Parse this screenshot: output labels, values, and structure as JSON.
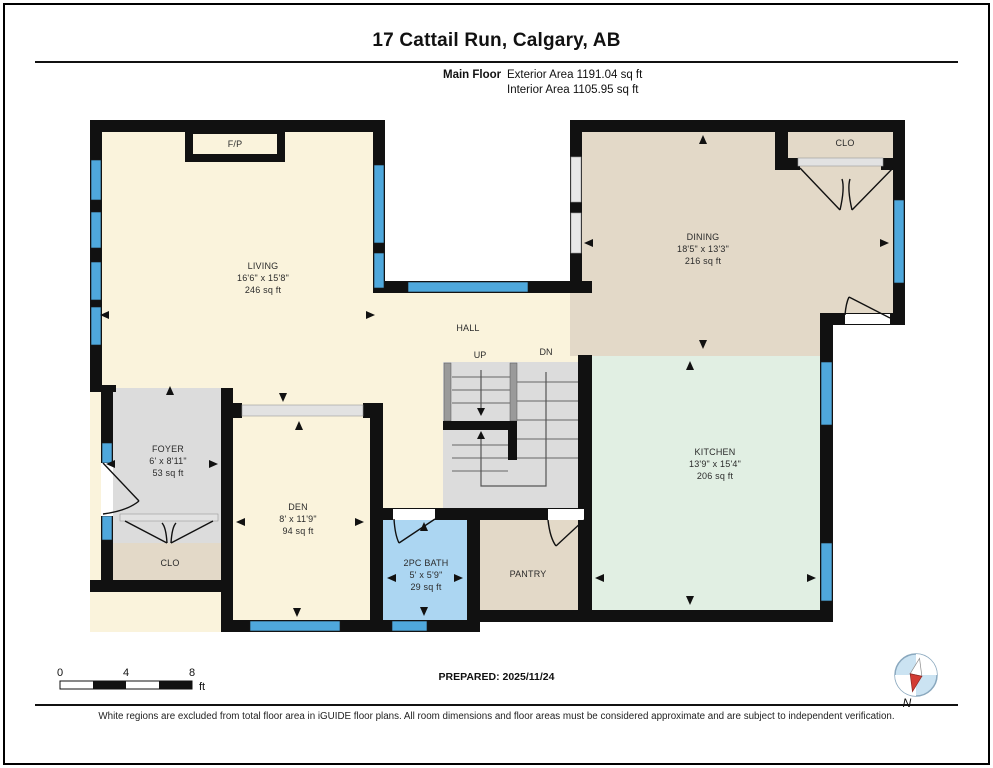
{
  "header": {
    "title": "17 Cattail Run, Calgary, AB",
    "floor_label": "Main Floor",
    "exterior_area": "Exterior Area 1191.04 sq ft",
    "interior_area": "Interior Area 1105.95 sq ft"
  },
  "rooms": {
    "living": {
      "name": "LIVING",
      "dims": "16'6\" x 15'8\"",
      "area": "246 sq ft"
    },
    "dining": {
      "name": "DINING",
      "dims": "18'5\" x 13'3\"",
      "area": "216 sq ft"
    },
    "kitchen": {
      "name": "KITCHEN",
      "dims": "13'9\" x 15'4\"",
      "area": "206 sq ft"
    },
    "foyer": {
      "name": "FOYER",
      "dims": "6' x 8'11\"",
      "area": "53 sq ft"
    },
    "den": {
      "name": "DEN",
      "dims": "8' x 11'9\"",
      "area": "94 sq ft"
    },
    "bath": {
      "name": "2PC BATH",
      "dims": "5' x 5'9\"",
      "area": "29 sq ft"
    },
    "pantry": {
      "name": "PANTRY"
    },
    "hall": {
      "name": "HALL"
    },
    "closet_upper": {
      "name": "CLO"
    },
    "closet_lower": {
      "name": "CLO"
    },
    "fireplace": {
      "name": "F/P"
    }
  },
  "stairs": {
    "up_label": "UP",
    "down_label": "DN"
  },
  "scale_bar": {
    "tick_0": "0",
    "tick_4": "4",
    "tick_8": "8",
    "unit": "ft"
  },
  "compass": {
    "north_label": "N"
  },
  "footer": {
    "prepared": "PREPARED: 2025/11/24",
    "disclaimer": "White regions are excluded from total floor area in iGUIDE floor plans. All room dimensions and floor areas must be considered approximate and are subject to independent verification."
  },
  "colors": {
    "wall": "#111111",
    "room_cream": "#FAF3DC",
    "room_tan": "#E3D9C8",
    "room_mint": "#E1EFE3",
    "room_gray": "#DCDCDC",
    "room_bath_blue": "#ACD6F2",
    "window_blue": "#4FA8DC",
    "compass_blue": "#CBE3F2",
    "compass_red": "#D23B33"
  }
}
